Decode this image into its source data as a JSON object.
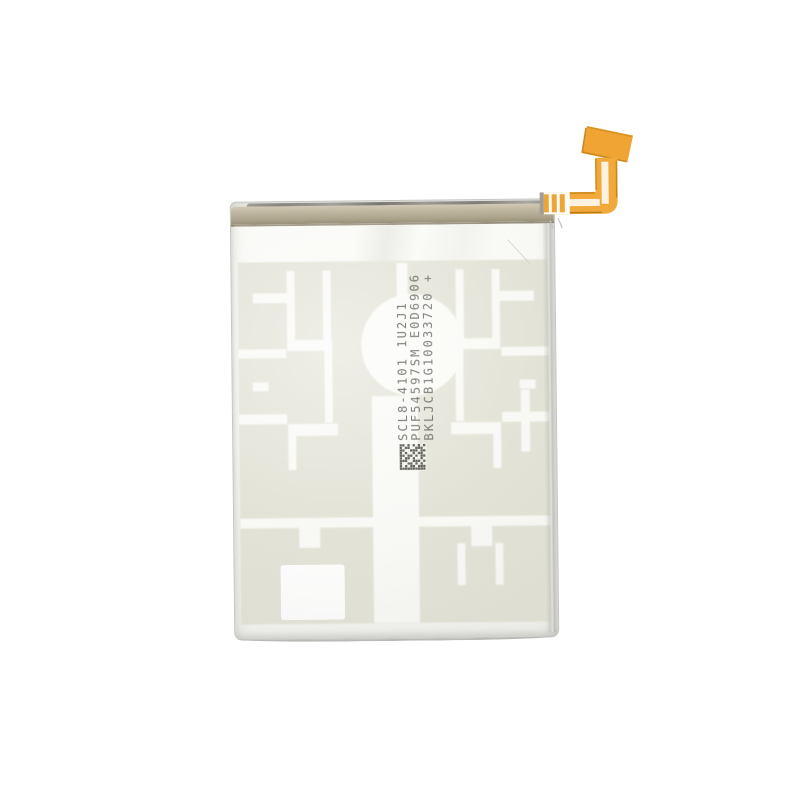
{
  "scene": {
    "title": "Replacement phone battery product photo",
    "description": "Silver foil lithium-polymer phone battery on a white background, tan heat-seal tape along the top edge, an orange L-shaped flex cable connector exiting the top right corner, a pale sage electrode grid pattern visible through the foil, a round indent in the upper middle, printed lot codes rotated vertically with a small data-matrix code, and a white square sticker near the bottom left",
    "background_color": "#ffffff"
  },
  "battery": {
    "markings": {
      "line1": "SCL8-4101 1U2J1",
      "line2": "PUF54597SM E0D6906",
      "line3": "BKLJCB1G10033720 +"
    },
    "datamatrix": {
      "rows": [
        "1101010101",
        "1011001110",
        "1100111011",
        "1010010110",
        "1101101011",
        "1011010010",
        "1110011101",
        "1001101010",
        "1010110111",
        "1111111111"
      ]
    },
    "colors": {
      "background": "#ffffff",
      "foil": "#f9f9f6",
      "foil_edge": "#c6c6c2",
      "seal_band": "#b7ae99",
      "seal_edge_dark": "#6f6e64",
      "electrode_pattern": "#e1e1d4",
      "pattern_cut": "#fafaf7",
      "sticker_patch": "#ffffff",
      "flex_cable": "#f2a93c",
      "flex_trace_dark": "#c8871d",
      "marking_text": "#63635e"
    }
  }
}
